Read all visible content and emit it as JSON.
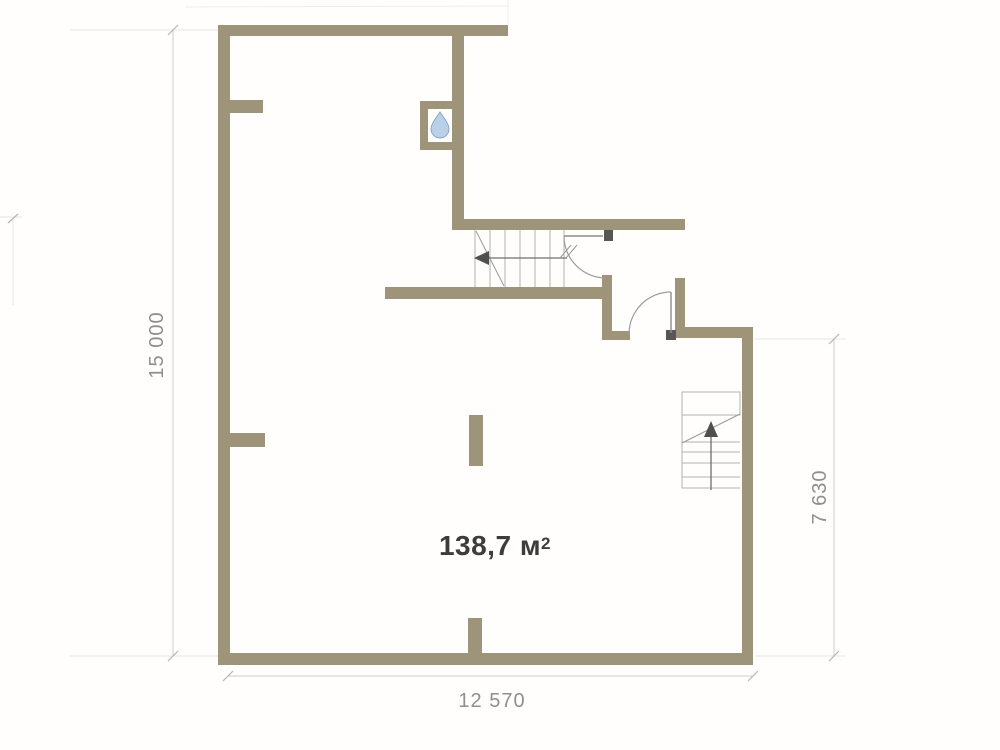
{
  "plan": {
    "area_label": {
      "value": "138,7",
      "unit": "м",
      "superscript": "2"
    },
    "dimensions": {
      "left": "15 000",
      "bottom": "12 570",
      "right": "7 630"
    },
    "icons": {
      "water_drop": "water-drop-icon"
    },
    "colors": {
      "wall": "#9d947a",
      "dimension_text": "#8f8f8f",
      "dimension_line": "#cfcfcf",
      "area_text": "#3c3c3c",
      "stair_lines": "#b3b3b3",
      "door_lines": "#9c9c9c",
      "drop_blue": "#b9d0e8"
    },
    "walls": [
      {
        "x": 218,
        "y": 27,
        "w": 12,
        "h": 637
      },
      {
        "x": 218,
        "y": 25,
        "w": 290,
        "h": 11
      },
      {
        "x": 452,
        "y": 36,
        "w": 12,
        "h": 186
      },
      {
        "x": 420,
        "y": 101,
        "w": 32,
        "h": 8
      },
      {
        "x": 420,
        "y": 101,
        "w": 8,
        "h": 49
      },
      {
        "x": 420,
        "y": 142,
        "w": 32,
        "h": 8
      },
      {
        "x": 452,
        "y": 219,
        "w": 233,
        "h": 11
      },
      {
        "x": 385,
        "y": 287,
        "w": 220,
        "h": 12
      },
      {
        "x": 602,
        "y": 275,
        "w": 10,
        "h": 58
      },
      {
        "x": 602,
        "y": 331,
        "w": 28,
        "h": 9
      },
      {
        "x": 675,
        "y": 278,
        "w": 10,
        "h": 60
      },
      {
        "x": 675,
        "y": 327,
        "w": 78,
        "h": 11
      },
      {
        "x": 742,
        "y": 327,
        "w": 11,
        "h": 337
      },
      {
        "x": 218,
        "y": 653,
        "w": 535,
        "h": 12
      },
      {
        "x": 468,
        "y": 618,
        "w": 14,
        "h": 35
      },
      {
        "x": 229,
        "y": 100,
        "w": 34,
        "h": 13
      },
      {
        "x": 229,
        "y": 433,
        "w": 36,
        "h": 14
      },
      {
        "x": 469,
        "y": 415,
        "w": 14,
        "h": 51
      }
    ],
    "stairs_top": {
      "treads_x": [
        475,
        490,
        505,
        520,
        535,
        550,
        564
      ],
      "y1": 230,
      "y2": 287
    },
    "stairs_right": {
      "treads_y": [
        442,
        452,
        463,
        477,
        488
      ],
      "x1": 682,
      "x2": 740,
      "landing": {
        "x": 682,
        "y": 392,
        "w": 58,
        "h": 23
      }
    }
  }
}
